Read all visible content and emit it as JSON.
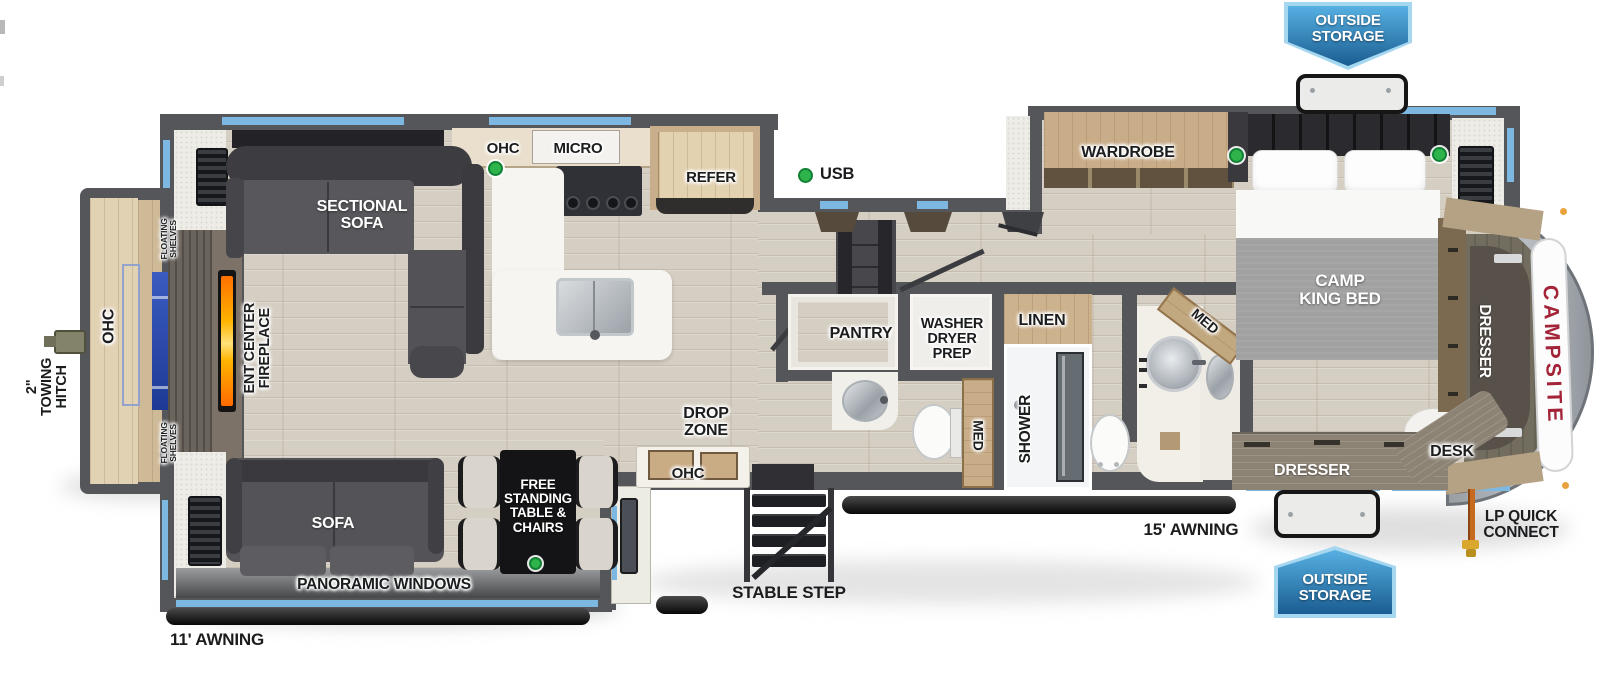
{
  "page": {
    "description": "Fifth wheel travel trailer floor plan diagram"
  },
  "brand": {
    "name_color": "#a32438"
  },
  "colors": {
    "wall": "#55565a",
    "floor_wood": "#d5cec2",
    "window_accent": "#7db8e2",
    "banner_blue_light": "#57b0e2",
    "banner_blue_dark": "#1a5d92",
    "brand_red": "#a32438",
    "indicator_green": "#2eb44b",
    "fireplace_flame": "#ff8c00",
    "cabinet_wood": "#c9ad89"
  },
  "labels": {
    "outside_storage_top": "OUTSIDE\nSTORAGE",
    "outside_storage_bottom": "OUTSIDE\nSTORAGE",
    "wardrobe": "WARDROBE",
    "camp_king_bed": "CAMP\nKING BED",
    "dresser_side": "DRESSER",
    "dresser_front": "DRESSER",
    "desk": "DESK",
    "lp_quick_connect": "LP QUICK\nCONNECT",
    "awning_front": "15' AWNING",
    "awning_rear": "11' AWNING",
    "stable_step": "STABLE STEP",
    "med_hall": "MED",
    "med_front": "MED",
    "shower": "SHOWER",
    "linen": "LINEN",
    "washer_dryer_prep": "WASHER\nDRYER\nPREP",
    "pantry": "PANTRY",
    "drop_zone": "DROP\nZONE",
    "ohc_drop_zone": "OHC",
    "ohc_kitchen": "OHC",
    "micro": "MICRO",
    "refer": "REFER",
    "usb": "USB",
    "sectional_sofa": "SECTIONAL\nSOFA",
    "sofa": "SOFA",
    "free_standing_table": "FREE\nSTANDING\nTABLE &\nCHAIRS",
    "panoramic_windows": "PANORAMIC WINDOWS",
    "ent_center_fireplace": "ENT CENTER\nFIREPLACE",
    "ohc_rear": "OHC",
    "floating_shelves_top": "FLOATING\nSHELVES",
    "floating_shelves_bottom": "FLOATING\nSHELVES",
    "towing_hitch": "2\"\nTOWING\nHITCH",
    "campsite": "CAMPSITE"
  }
}
